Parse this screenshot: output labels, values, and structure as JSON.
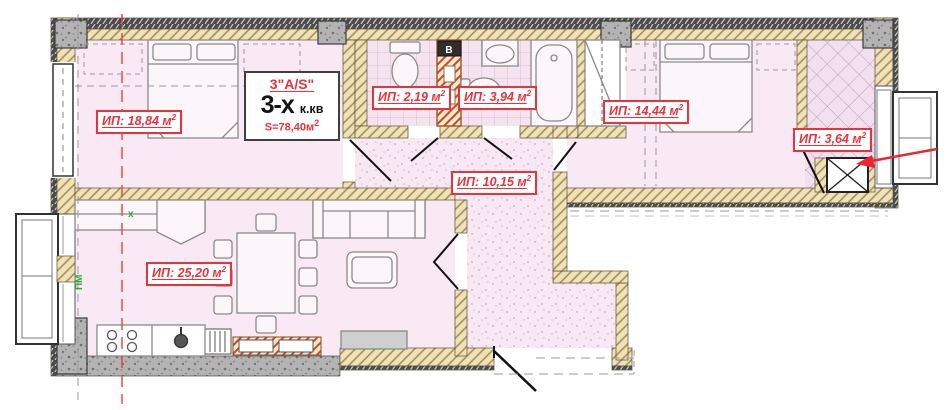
{
  "apartment_info": {
    "type_code": "3\"A/S\"",
    "rooms_count": "3-х",
    "rooms_unit": "к.кв",
    "area_text": "S=78,40м",
    "area_sup": "2"
  },
  "area_labels": {
    "bedroom1": {
      "text": "ИП: 18,84 м",
      "sup": "2"
    },
    "wc": {
      "text": "ИП: 2,19 м",
      "sup": "2"
    },
    "bathroom": {
      "text": "ИП: 3,94 м",
      "sup": "2"
    },
    "bedroom2": {
      "text": "ИП: 14,44 м",
      "sup": "2"
    },
    "loggia": {
      "text": "ИП: 3,64 м",
      "sup": "2"
    },
    "hallway": {
      "text": "ИП: 10,15 м",
      "sup": "2"
    },
    "living_kitchen": {
      "text": "ИП: 25,20 м",
      "sup": "2"
    }
  },
  "annotations": {
    "window_mark": "ПМ",
    "axis_cross_mark": "x",
    "vent_mark": "В"
  },
  "colors": {
    "label_red": "#e8323c",
    "arrow_red": "#ee2435",
    "axis_red": "#e84040",
    "wall_beige": "#f0e2b6",
    "floor_pink": "#f8e9f5",
    "concrete_gray": "#b3b3b3",
    "mark_green": "#2faa35"
  }
}
